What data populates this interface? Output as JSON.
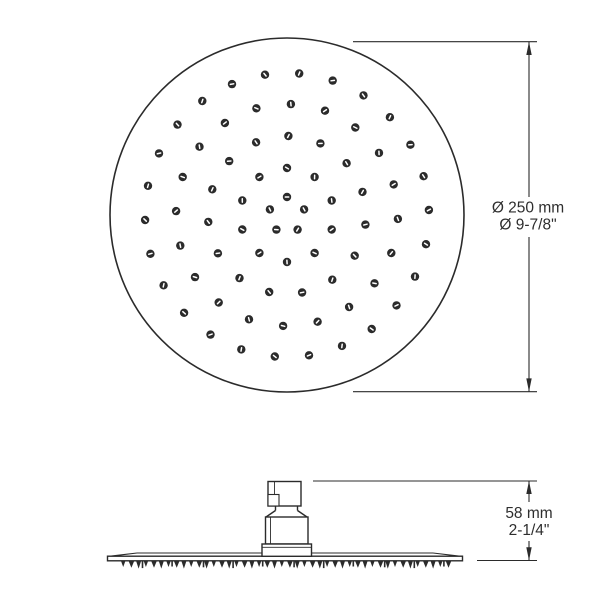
{
  "drawing": {
    "background": "#ffffff",
    "ink": "#2b2b2b",
    "text_color": "#2e2e2e"
  },
  "top_view": {
    "center_x": 287,
    "center_y": 215,
    "radius": 177,
    "nozzle_dot_radius": 4.2,
    "nozzle_rings": [
      {
        "radius": 18,
        "count": 5,
        "offset_deg": -90
      },
      {
        "radius": 47,
        "count": 10,
        "offset_deg": -18
      },
      {
        "radius": 79,
        "count": 15,
        "offset_deg": 7
      },
      {
        "radius": 111,
        "count": 20,
        "offset_deg": 2
      },
      {
        "radius": 142,
        "count": 26,
        "offset_deg": -2
      }
    ]
  },
  "side_view": {
    "teeth": {
      "x_start": 121,
      "x_end": 451,
      "base_y": 561,
      "period": 7.55
    }
  },
  "dimensions": {
    "diameter": {
      "metric": "Ø 250 mm",
      "imperial": "Ø 9-7/8\""
    },
    "height": {
      "metric": "58 mm",
      "imperial": "2-1/4\""
    }
  }
}
